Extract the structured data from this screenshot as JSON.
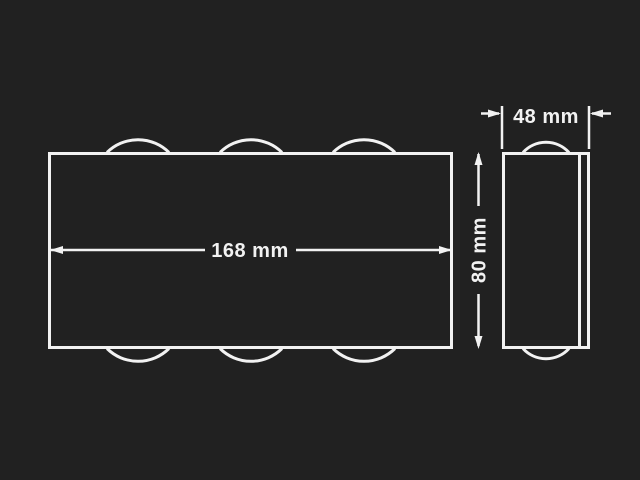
{
  "diagram": {
    "type": "technical-dimension-drawing",
    "subject": "wall-lamp-front-and-side-views",
    "background_color": "#212121",
    "line_color": "#f2f2f2",
    "labels": {
      "front_width": "168 mm",
      "side_height": "80 mm",
      "side_depth": "48 mm"
    },
    "dimensions_mm": {
      "width": 168,
      "height": 80,
      "depth": 48
    }
  }
}
